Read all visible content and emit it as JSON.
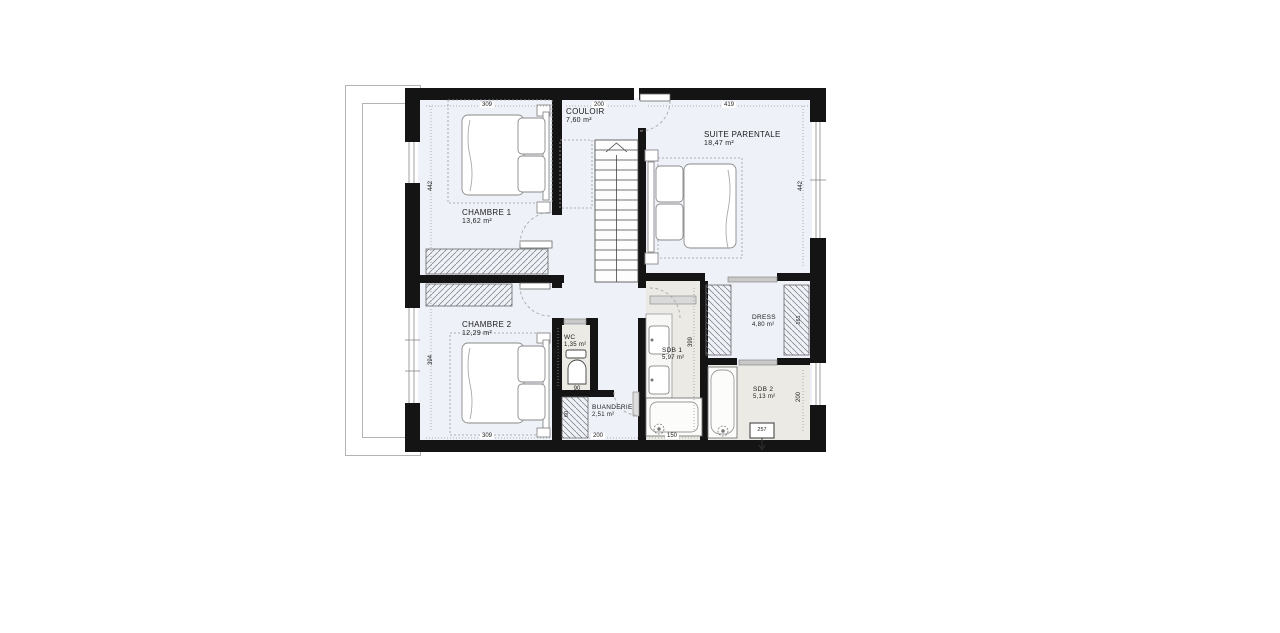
{
  "rooms": {
    "couloir": {
      "name": "COULOIR",
      "area": "7,60 m²"
    },
    "chambre1": {
      "name": "CHAMBRE 1",
      "area": "13,62 m²"
    },
    "suite": {
      "name": "SUITE PARENTALE",
      "area": "18,47 m²"
    },
    "chambre2": {
      "name": "CHAMBRE 2",
      "area": "12,29 m²"
    },
    "wc": {
      "name": "WC",
      "area": "1,35 m²"
    },
    "buanderie": {
      "name": "BUANDERIE",
      "area": "2,51 m²"
    },
    "sdb1": {
      "name": "SDB 1",
      "area": "5,97 m²"
    },
    "dress": {
      "name": "DRESS",
      "area": "4,80 m²"
    },
    "sdb2": {
      "name": "SDB 2",
      "area": "5,13 m²"
    }
  },
  "dims": {
    "top_chambre1": "309",
    "top_couloir": "200",
    "top_suite": "419",
    "bottom_chambre2": "309",
    "bottom_buanderie": "200",
    "bottom_sdb1": "150",
    "left_chambre1": "442",
    "left_chambre2": "394",
    "right_suite": "442",
    "right_sdb2": "200",
    "wc_width": "90",
    "wc_height": "150",
    "sdb1_height": "399",
    "dress_wardrobe": "161",
    "buanderie_unit": "60",
    "sdb2_fixture": "257"
  },
  "colors": {
    "wall": "#141414",
    "floor_dry": "#eef1f8",
    "floor_wet": "#ebeae4",
    "dash": "#9a9a9a"
  }
}
